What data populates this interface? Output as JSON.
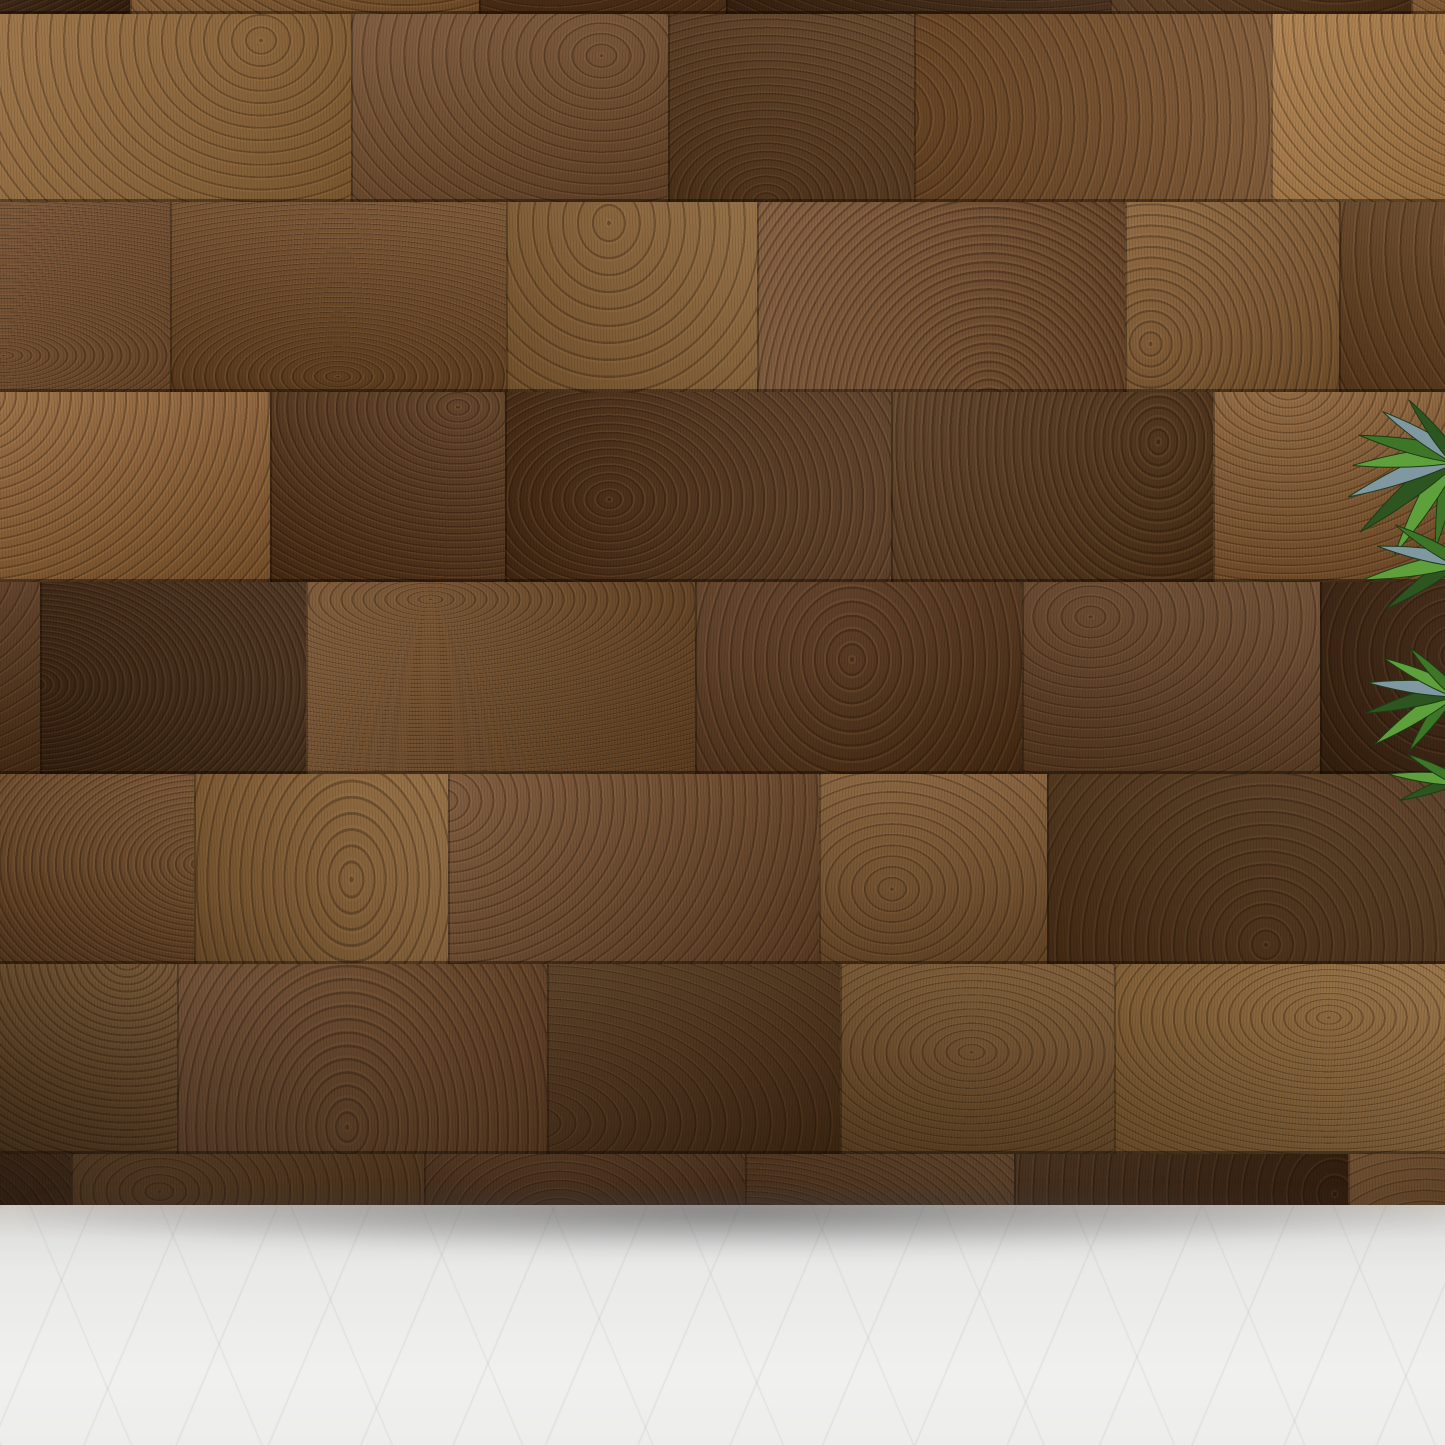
{
  "size_guide": {
    "unit_suffix": "CM",
    "options": [
      {
        "width_label": "80CM",
        "height_label": "120CM",
        "width_cm": 80,
        "height_cm": 120
      },
      {
        "width_label": "70CM",
        "height_label": "100CM",
        "width_cm": 70,
        "height_cm": 100
      },
      {
        "width_label": "60CM",
        "height_label": "80CM",
        "width_cm": 60,
        "height_cm": 80
      },
      {
        "width_label": "40CM",
        "height_label": "60CM",
        "width_cm": 40,
        "height_cm": 60
      }
    ]
  },
  "colors": {
    "overlay_fill": "rgba(255,255,255,0.47)",
    "overlay_border": "#2e2a25",
    "label_fill": "#ffffff",
    "label_outline": "#57524d",
    "sofa_fabric": "#a6b0bc",
    "headrest_quilt": "#46515e",
    "bolster_cap": "#74808e",
    "table_wood": "#d2a25c",
    "table_front": "#f3ecdc",
    "wall_wood_dark": "#47290f",
    "wall_wood_light": "#a4783f",
    "floor": "#ebebe9",
    "plant_green": "#4e8c33",
    "legs_metal": "#1d1f22"
  }
}
